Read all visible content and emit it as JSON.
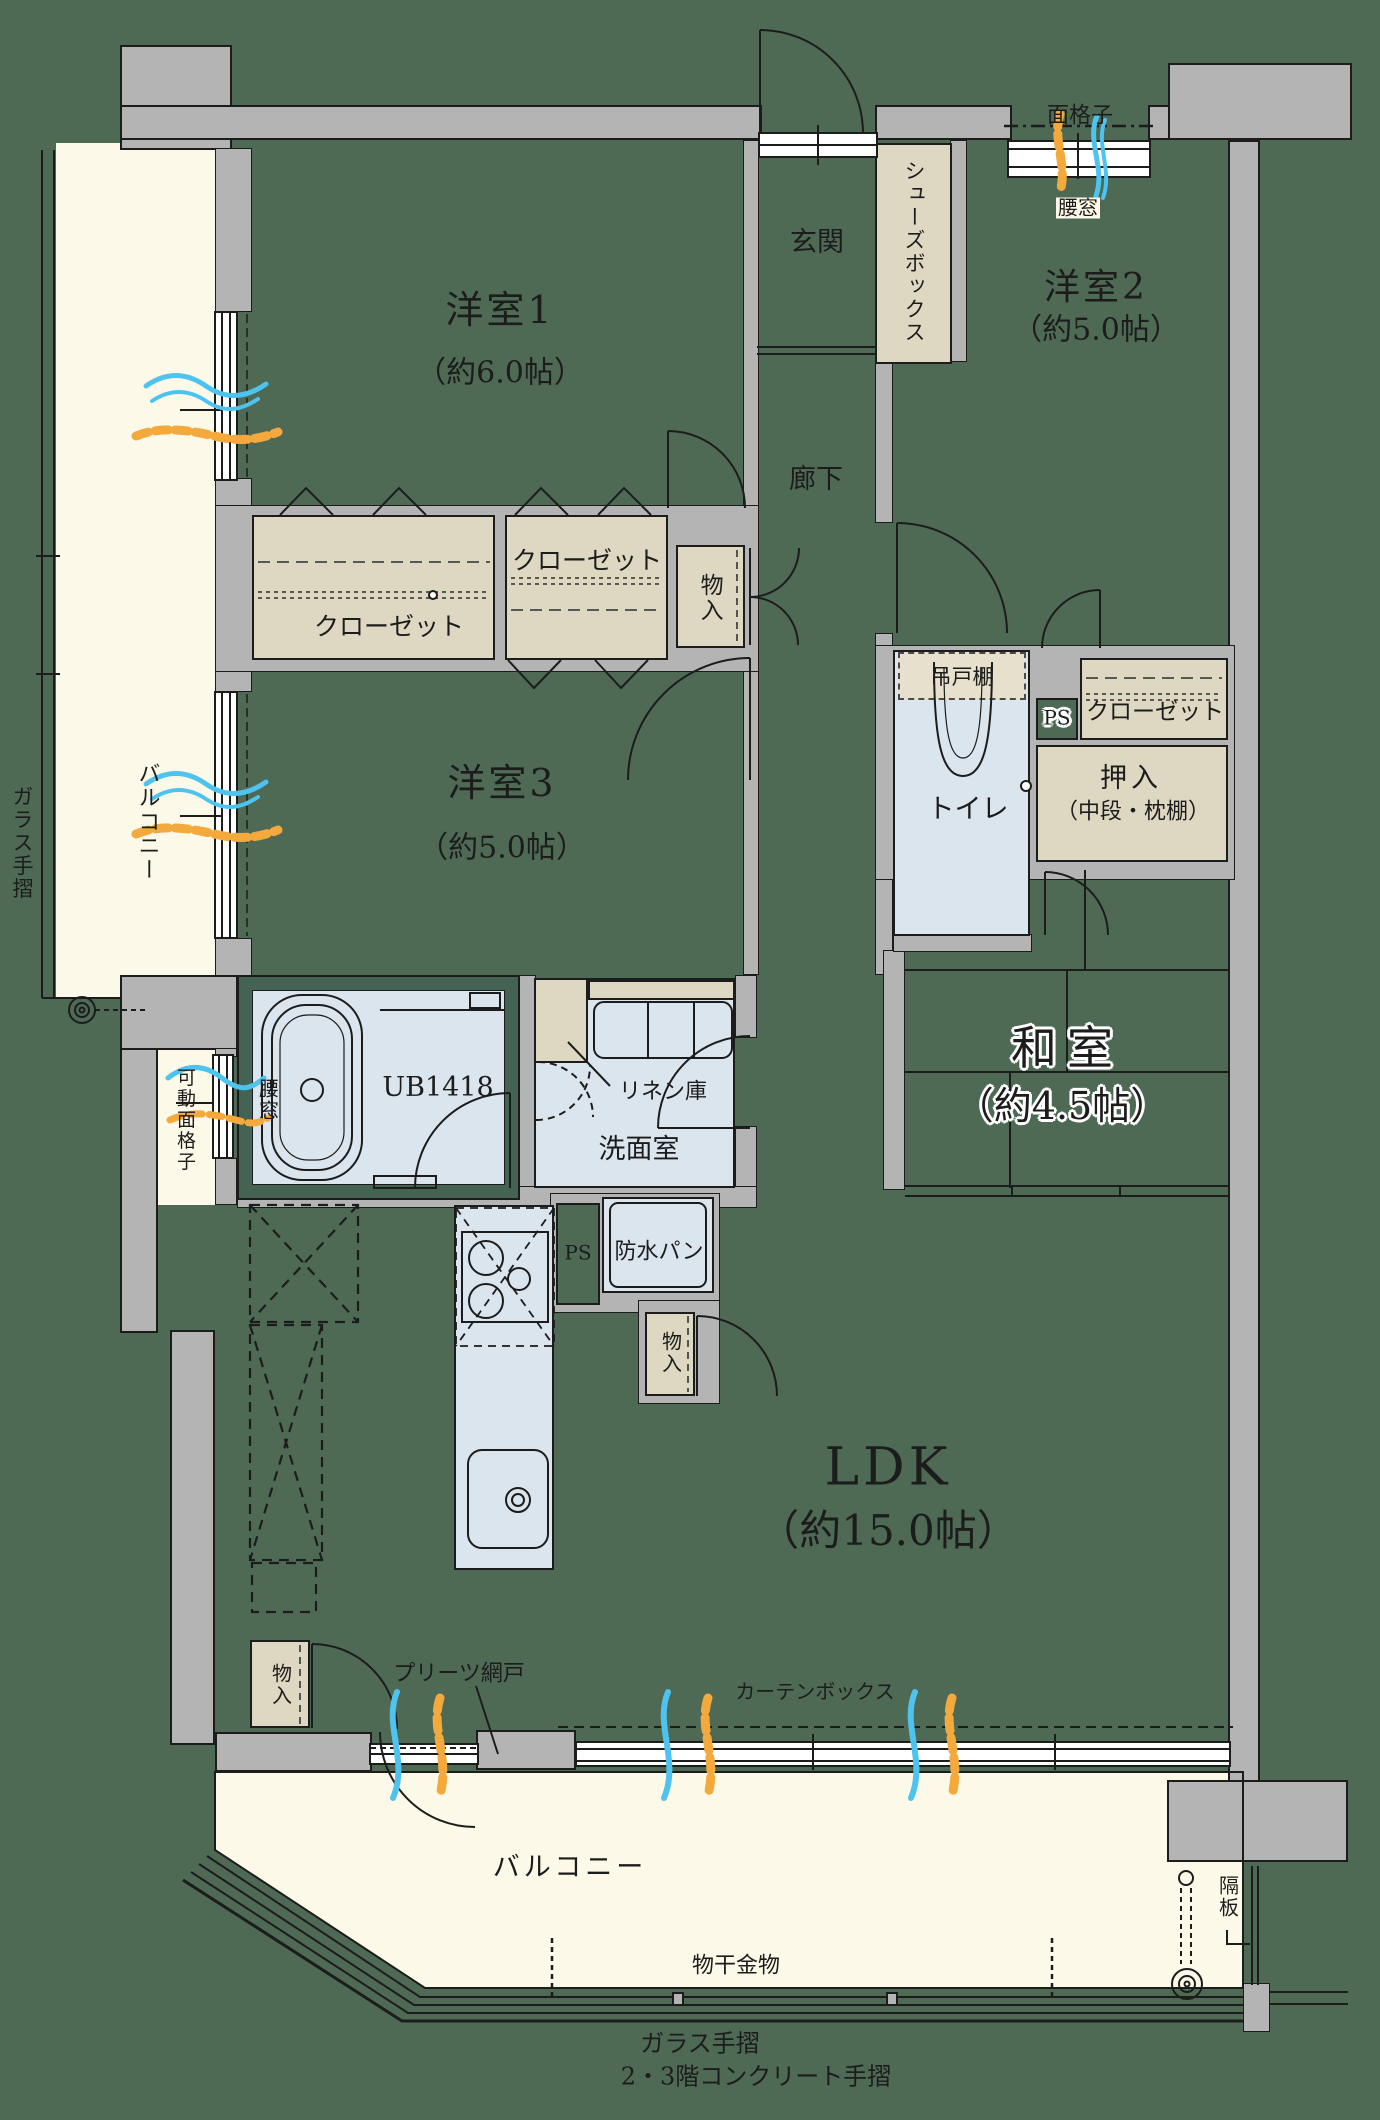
{
  "page": {
    "type": "apartment-floorplan"
  },
  "colors": {
    "background": "#4e6a55",
    "wall": "#b4b4b4",
    "balcony": "#fdf9e8",
    "wet_room": "#dbe5ee",
    "closet": "#ded8c2",
    "bath_frame": "#456353",
    "line": "#1c1c1c",
    "airflow_blue": "#4fc3ef",
    "airflow_orange": "#f3a93c",
    "halo": "#ffffff"
  },
  "rooms": {
    "yoshitsu1": {
      "name": "洋室1",
      "size": "（約6.0帖）"
    },
    "yoshitsu2": {
      "name": "洋室2",
      "size": "（約5.0帖）"
    },
    "yoshitsu3": {
      "name": "洋室3",
      "size": "（約5.0帖）"
    },
    "washitsu": {
      "name": "和室",
      "size": "（約4.5帖）"
    },
    "ldk": {
      "name": "LDK",
      "size": "（約15.0帖）"
    },
    "genkan": "玄関",
    "rouka": "廊下",
    "toilet": "トイレ",
    "senmenshitsu": "洗面室",
    "balcony_main": "バルコニー",
    "balcony_left": "バルコニー"
  },
  "fixtures": {
    "shoes_box": "シューズボックス",
    "closet_a": "クローゼット",
    "closet_b": "クローゼット",
    "closet_c": "クローゼット",
    "oshiire": "押入",
    "oshiire_note": "（中段・枕棚）",
    "tsuridana": "吊戸棚",
    "ps_toilet": "PS",
    "ps_kitchen": "PS",
    "mono_row": "物入",
    "mono_kitchen": "物入",
    "mono_bottom": "物入",
    "linen": "リネン庫",
    "ub": "UB1418",
    "bousui_pan": "防水パン"
  },
  "annotations": {
    "menkoushi": "面格子",
    "koshimado_top": "腰窓",
    "koshimado_bath": "腰窓",
    "kadou_menkoushi": "可動面格子",
    "pleats_amido": "プリーツ網戸",
    "curtain_box": "カーテンボックス",
    "monohoshi": "物干金物",
    "kakuita": "隔板",
    "glass_left": "ガラス手摺",
    "glass_bottom": "ガラス手摺",
    "concrete_rail": "2・3階コンクリート手摺"
  }
}
